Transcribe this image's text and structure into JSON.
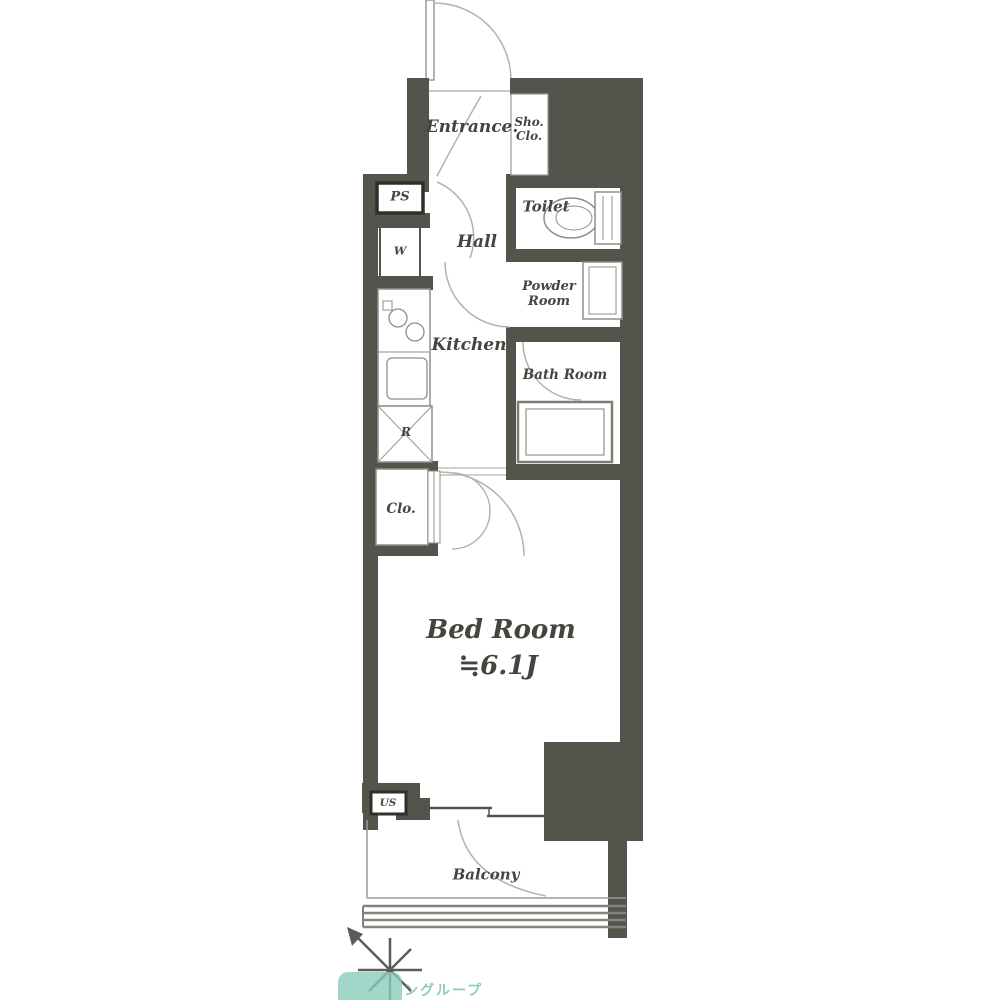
{
  "title": "apartment-floor-plan",
  "rooms": {
    "entrance": {
      "label": "Entrance."
    },
    "shoe_closet": {
      "line1": "Sho.",
      "line2": "Clo."
    },
    "pipe_space": {
      "label": "PS"
    },
    "washer": {
      "label": "W"
    },
    "hall": {
      "label": "Hall"
    },
    "toilet": {
      "label": "Toilet"
    },
    "powder_room": {
      "line1": "Powder",
      "line2": "Room"
    },
    "kitchen": {
      "label": "Kitchen"
    },
    "bath_room": {
      "label": "Bath Room"
    },
    "refrigerator": {
      "label": "R"
    },
    "closet": {
      "label": "Clo."
    },
    "bed_room": {
      "label": "Bed Room",
      "size": "≒6.1J"
    },
    "utility_space": {
      "label": "US"
    },
    "balcony": {
      "label": "Balcony"
    }
  },
  "watermark": {
    "logo_text": "ングループ",
    "compass_icon": "north-arrow"
  },
  "colors": {
    "wall": "#55544c",
    "fixture_line": "#8f8f8a",
    "arc_line": "#b3b3ae",
    "label_text": "#45443f",
    "watermark_teal": "#8accba"
  }
}
